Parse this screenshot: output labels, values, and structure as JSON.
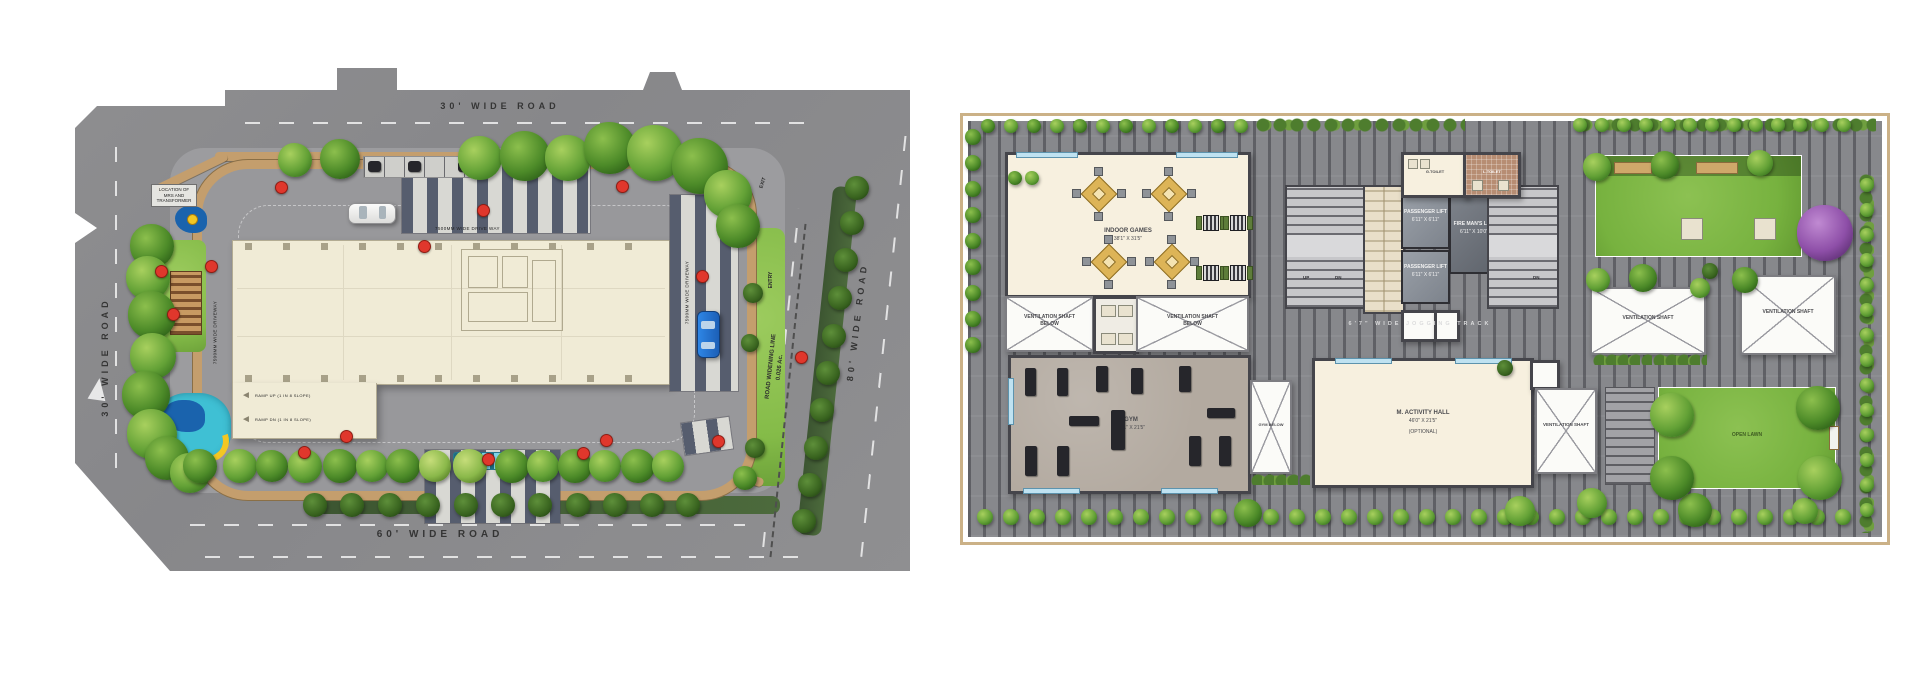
{
  "page": {
    "title": "Master Layout & Amenity Floor Plan"
  },
  "colors": {
    "road_gray": "#8b8b8d",
    "building_cream": "#f0ebd6",
    "sidewalk_tan": "#c49e6d",
    "paver_dark": "#565d6e",
    "lawn_green": "#7cb342",
    "marker_red": "#e0372c",
    "water_cyan": "#7fd4e8",
    "purple_tree": "#8e4fa8",
    "track_gray": "#87888c"
  },
  "icons": {
    "tree": "tree-icon",
    "marker": "marker-icon",
    "car_white": "white-car-icon",
    "car_blue": "blue-car-icon",
    "road_arrow": "road-arrow-icon"
  },
  "site_plan": {
    "roads": {
      "top": "30'  WIDE  ROAD",
      "left": "30'  WIDE  ROAD",
      "bottom": "60'  WIDE  ROAD",
      "right": "80'  WIDE  ROAD"
    },
    "widening": {
      "line1": "ROAD WIDENING LINE",
      "line2": "0.026 Ac."
    },
    "gates": {
      "entry": "ENTRY",
      "exit": "EXIT"
    },
    "notes": {
      "transformer": "LOCATION OF MRS AND TRANSFORMER",
      "drive_top": "7500MM WIDE DRIVE WAY",
      "drive_left": "7500MM WIDE DRIVEWAY",
      "drive_bottom": "7500MM WIDE DRIVEWAY",
      "drive_right": "7500MM WIDE DRIVEWAY",
      "ramp_up": "RAMP UP (1 IN 8 SLOPE)",
      "ramp_dn": "RAMP DN (1 IN 8 SLOPE)"
    }
  },
  "floor_plan": {
    "rooms": {
      "indoor_games": {
        "name": "INDOOR GAMES",
        "dim": "38'1\" X 31'5\""
      },
      "vent_shaft_below": {
        "name": "VENTILATION SHAFT",
        "sub": "BELOW"
      },
      "gym": {
        "name": "GYM",
        "dim": "38'1\" X 21'5\""
      },
      "gym_below": {
        "name": "GYM BELOW"
      },
      "passenger_lift": {
        "name": "PASSENGER LIFT",
        "dim": "6'11\" X 6'11\""
      },
      "fire_lift": {
        "name": "FIRE MAN'S LIFT",
        "dim": "6'11\" X 10'0\""
      },
      "activity_hall": {
        "name": "M. ACTIVITY HALL",
        "dim": "46'0\" X 21'5\"",
        "note": "(OPTIONAL)"
      },
      "vent_shaft": {
        "name": "VENTILATION SHAFT"
      },
      "open_lawn": {
        "name": "OPEN LAWN"
      },
      "g_toilet": {
        "name": "G.TOILET"
      },
      "l_toilet": {
        "name": "L.TOILET"
      }
    },
    "track": {
      "label": "6'7\" WIDE JOGGING TRACK"
    },
    "stairs": {
      "up": "UP",
      "dn": "DN"
    }
  }
}
